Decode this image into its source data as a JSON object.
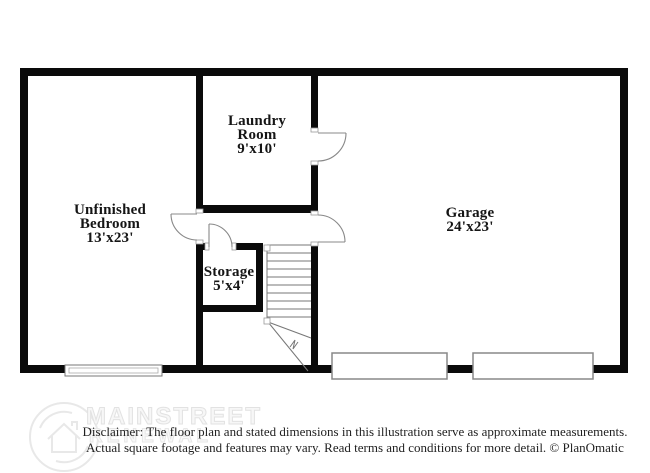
{
  "plan": {
    "rooms": {
      "laundry": {
        "name": "Laundry Room",
        "dims": "9'x10'"
      },
      "bedroom": {
        "name": "Unfinished Bedroom",
        "dims": "13'x23'"
      },
      "storage": {
        "name": "Storage",
        "dims": "5'x4'"
      },
      "garage": {
        "name": "Garage",
        "dims": "24'x23'"
      }
    }
  },
  "watermark": {
    "line1": "MAINSTREET",
    "line2": "RENEWAL",
    "logo_icon": "house-in-circle-icon"
  },
  "disclaimer": {
    "line1": "Disclaimer: The floor plan and stated dimensions in this illustration serve as approximate measurements.",
    "line2": "Actual square footage and features may vary. Read terms and conditions for more detail. © PlanOmatic"
  },
  "colors": {
    "wall": "#0a0a0a",
    "thin_line": "#777777",
    "label_text": "#151515",
    "watermark": "#e2e2e2"
  }
}
